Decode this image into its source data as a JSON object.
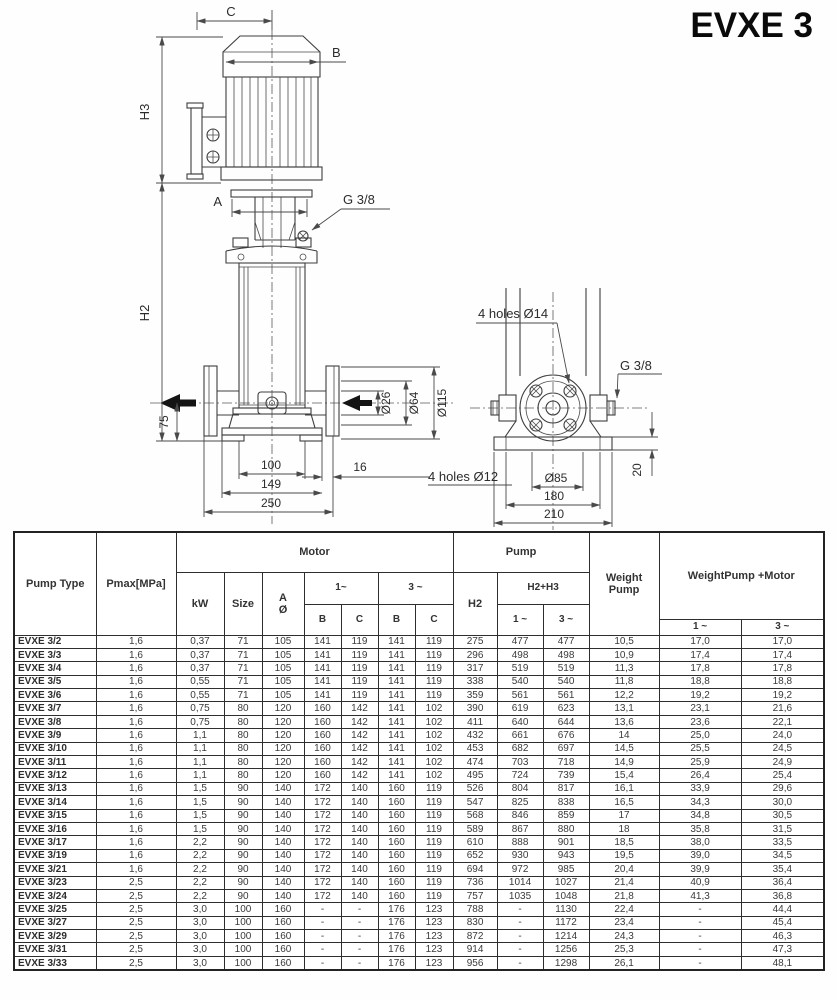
{
  "title": "EVXE 3",
  "drawing": {
    "front": {
      "c": "C",
      "b": "B",
      "h3": "H3",
      "a": "A",
      "g38": "G 3/8",
      "h2": "H2",
      "d75": "75",
      "d26": "Ø26",
      "d64": "Ø64",
      "d115": "Ø115",
      "w100": "100",
      "w149": "149",
      "w250": "250",
      "w16": "16"
    },
    "base": {
      "holes14": "4 holes Ø14",
      "g38": "G 3/8",
      "holes12": "4 holes Ø12",
      "d85": "Ø85",
      "w180": "180",
      "w210": "210",
      "h20": "20"
    }
  },
  "table": {
    "headers": {
      "pump_type": "Pump Type",
      "pmax": "Pmax[MPa]",
      "motor": "Motor",
      "kw": "kW",
      "size": "Size",
      "a_line1": "A",
      "a_line2": "Ø",
      "one_phase_motor": "1~",
      "three_phase_motor": "3 ~",
      "b1": "B",
      "c1": "C",
      "b3": "B",
      "c3": "C",
      "pump": "Pump",
      "h2": "H2",
      "h2h3": "H2+H3",
      "one_phase_h": "1 ~",
      "three_phase_h": "3 ~",
      "weight_line1": "Weight",
      "weight_line2": "Pump",
      "weight_pm": "WeightPump +Motor",
      "one_phase_w": "1 ~",
      "three_phase_w": "3 ~"
    },
    "rows": [
      [
        "EVXE 3/2",
        "1,6",
        "0,37",
        "71",
        "105",
        "141",
        "119",
        "141",
        "119",
        "275",
        "477",
        "477",
        "10,5",
        "17,0",
        "17,0"
      ],
      [
        "EVXE 3/3",
        "1,6",
        "0,37",
        "71",
        "105",
        "141",
        "119",
        "141",
        "119",
        "296",
        "498",
        "498",
        "10,9",
        "17,4",
        "17,4"
      ],
      [
        "EVXE 3/4",
        "1,6",
        "0,37",
        "71",
        "105",
        "141",
        "119",
        "141",
        "119",
        "317",
        "519",
        "519",
        "11,3",
        "17,8",
        "17,8"
      ],
      [
        "EVXE 3/5",
        "1,6",
        "0,55",
        "71",
        "105",
        "141",
        "119",
        "141",
        "119",
        "338",
        "540",
        "540",
        "11,8",
        "18,8",
        "18,8"
      ],
      [
        "EVXE 3/6",
        "1,6",
        "0,55",
        "71",
        "105",
        "141",
        "119",
        "141",
        "119",
        "359",
        "561",
        "561",
        "12,2",
        "19,2",
        "19,2"
      ],
      [
        "EVXE 3/7",
        "1,6",
        "0,75",
        "80",
        "120",
        "160",
        "142",
        "141",
        "102",
        "390",
        "619",
        "623",
        "13,1",
        "23,1",
        "21,6"
      ],
      [
        "EVXE 3/8",
        "1,6",
        "0,75",
        "80",
        "120",
        "160",
        "142",
        "141",
        "102",
        "411",
        "640",
        "644",
        "13,6",
        "23,6",
        "22,1"
      ],
      [
        "EVXE 3/9",
        "1,6",
        "1,1",
        "80",
        "120",
        "160",
        "142",
        "141",
        "102",
        "432",
        "661",
        "676",
        "14",
        "25,0",
        "24,0"
      ],
      [
        "EVXE 3/10",
        "1,6",
        "1,1",
        "80",
        "120",
        "160",
        "142",
        "141",
        "102",
        "453",
        "682",
        "697",
        "14,5",
        "25,5",
        "24,5"
      ],
      [
        "EVXE 3/11",
        "1,6",
        "1,1",
        "80",
        "120",
        "160",
        "142",
        "141",
        "102",
        "474",
        "703",
        "718",
        "14,9",
        "25,9",
        "24,9"
      ],
      [
        "EVXE 3/12",
        "1,6",
        "1,1",
        "80",
        "120",
        "160",
        "142",
        "141",
        "102",
        "495",
        "724",
        "739",
        "15,4",
        "26,4",
        "25,4"
      ],
      [
        "EVXE 3/13",
        "1,6",
        "1,5",
        "90",
        "140",
        "172",
        "140",
        "160",
        "119",
        "526",
        "804",
        "817",
        "16,1",
        "33,9",
        "29,6"
      ],
      [
        "EVXE 3/14",
        "1,6",
        "1,5",
        "90",
        "140",
        "172",
        "140",
        "160",
        "119",
        "547",
        "825",
        "838",
        "16,5",
        "34,3",
        "30,0"
      ],
      [
        "EVXE 3/15",
        "1,6",
        "1,5",
        "90",
        "140",
        "172",
        "140",
        "160",
        "119",
        "568",
        "846",
        "859",
        "17",
        "34,8",
        "30,5"
      ],
      [
        "EVXE 3/16",
        "1,6",
        "1,5",
        "90",
        "140",
        "172",
        "140",
        "160",
        "119",
        "589",
        "867",
        "880",
        "18",
        "35,8",
        "31,5"
      ],
      [
        "EVXE 3/17",
        "1,6",
        "2,2",
        "90",
        "140",
        "172",
        "140",
        "160",
        "119",
        "610",
        "888",
        "901",
        "18,5",
        "38,0",
        "33,5"
      ],
      [
        "EVXE 3/19",
        "1,6",
        "2,2",
        "90",
        "140",
        "172",
        "140",
        "160",
        "119",
        "652",
        "930",
        "943",
        "19,5",
        "39,0",
        "34,5"
      ],
      [
        "EVXE 3/21",
        "1,6",
        "2,2",
        "90",
        "140",
        "172",
        "140",
        "160",
        "119",
        "694",
        "972",
        "985",
        "20,4",
        "39,9",
        "35,4"
      ],
      [
        "EVXE 3/23",
        "2,5",
        "2,2",
        "90",
        "140",
        "172",
        "140",
        "160",
        "119",
        "736",
        "1014",
        "1027",
        "21,4",
        "40,9",
        "36,4"
      ],
      [
        "EVXE 3/24",
        "2,5",
        "2,2",
        "90",
        "140",
        "172",
        "140",
        "160",
        "119",
        "757",
        "1035",
        "1048",
        "21,8",
        "41,3",
        "36,8"
      ],
      [
        "EVXE 3/25",
        "2,5",
        "3,0",
        "100",
        "160",
        "-",
        "-",
        "176",
        "123",
        "788",
        "-",
        "1130",
        "22,4",
        "-",
        "44,4"
      ],
      [
        "EVXE 3/27",
        "2,5",
        "3,0",
        "100",
        "160",
        "-",
        "-",
        "176",
        "123",
        "830",
        "-",
        "1172",
        "23,4",
        "-",
        "45,4"
      ],
      [
        "EVXE 3/29",
        "2,5",
        "3,0",
        "100",
        "160",
        "-",
        "-",
        "176",
        "123",
        "872",
        "-",
        "1214",
        "24,3",
        "-",
        "46,3"
      ],
      [
        "EVXE 3/31",
        "2,5",
        "3,0",
        "100",
        "160",
        "-",
        "-",
        "176",
        "123",
        "914",
        "-",
        "1256",
        "25,3",
        "-",
        "47,3"
      ],
      [
        "EVXE 3/33",
        "2,5",
        "3,0",
        "100",
        "160",
        "-",
        "-",
        "176",
        "123",
        "956",
        "-",
        "1298",
        "26,1",
        "-",
        "48,1"
      ]
    ]
  }
}
